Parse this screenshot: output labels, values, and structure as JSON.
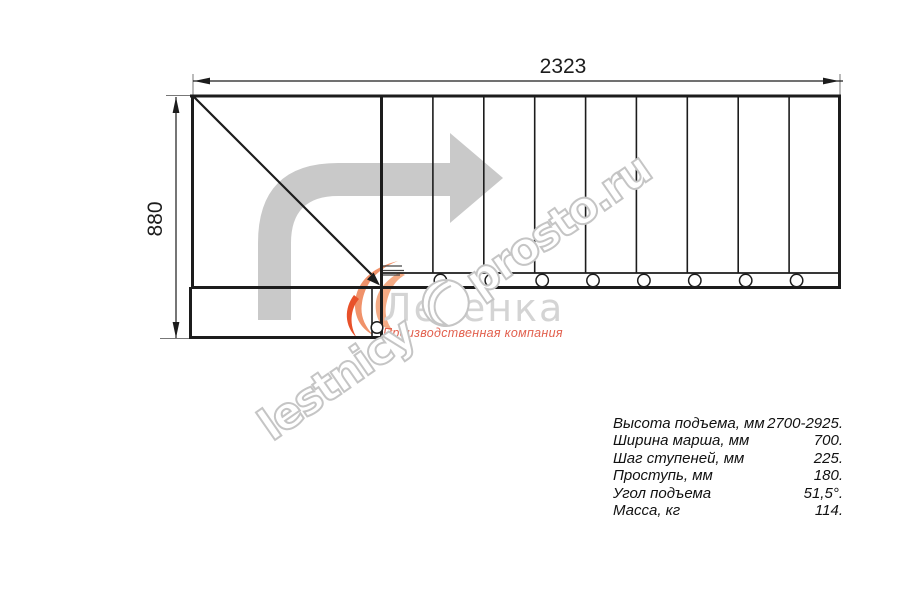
{
  "drawing": {
    "width_label": "2323",
    "height_label": "880"
  },
  "logo": {
    "brand": "Лесенка",
    "tagline": "Производственная компания"
  },
  "watermark": {
    "text_left": "lestnicy",
    "text_right": "prosto.ru"
  },
  "specs": {
    "rows": [
      {
        "label": "Высота подъема, мм",
        "value": "2700-2925."
      },
      {
        "label": "Ширина марша, мм",
        "value": "700."
      },
      {
        "label": "Шаг ступеней, мм",
        "value": "225."
      },
      {
        "label": "Проступь, мм",
        "value": "180."
      },
      {
        "label": "Угол подъема",
        "value": "51,5°."
      },
      {
        "label": "Масса, кг",
        "value": "114."
      }
    ]
  },
  "colors": {
    "line_black": "#1c1c1c",
    "direction_arrow_gray": "#c9c9c9",
    "watermark_gray": "#c5c5c5",
    "brand_gray": "#d4d4d4",
    "flame_orange_light": "#f0926a",
    "flame_orange_dark": "#e8512a",
    "tagline_red": "#e2604e"
  }
}
